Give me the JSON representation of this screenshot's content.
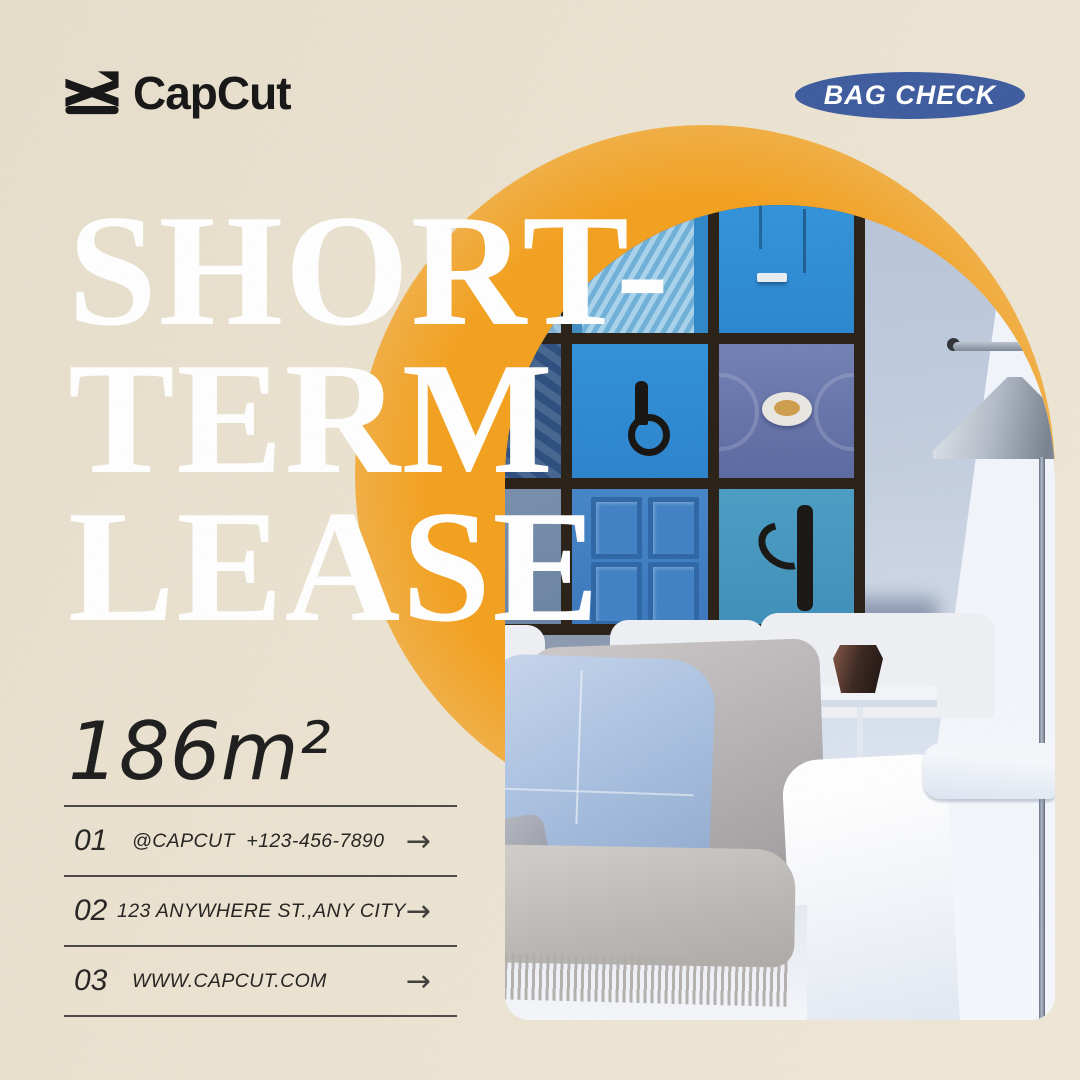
{
  "brand": {
    "name": "CapCut"
  },
  "badge": {
    "label": "BAG CHECK",
    "bg_color": "#3d5b9e",
    "text_color": "#ffffff"
  },
  "headline": {
    "lines": [
      "SHORT-",
      "TERM",
      "LEASE"
    ],
    "color": "#ffffff"
  },
  "area_label": "186m²",
  "contact_rows": [
    {
      "index": "01",
      "text": "@CAPCUT  +123-456-7890"
    },
    {
      "index": "02",
      "text": "123 ANYWHERE ST.,ANY CITY"
    },
    {
      "index": "03",
      "text": "WWW.CAPCUT.COM"
    }
  ],
  "ui": {
    "arrow": "→"
  },
  "colors": {
    "background_beige": "#ebe2d0",
    "accent_orange": "#f3a01d",
    "badge_blue": "#3d5b9e",
    "text_dark": "#1c1c1c",
    "headline_white": "#ffffff"
  },
  "photo": {
    "description": "Arched photo: living room with 3x3 gallery wall of blue door pictures, chrome floor lamp, white sofa with blue and gray pillows, fringed throw, side table with dark vase"
  }
}
